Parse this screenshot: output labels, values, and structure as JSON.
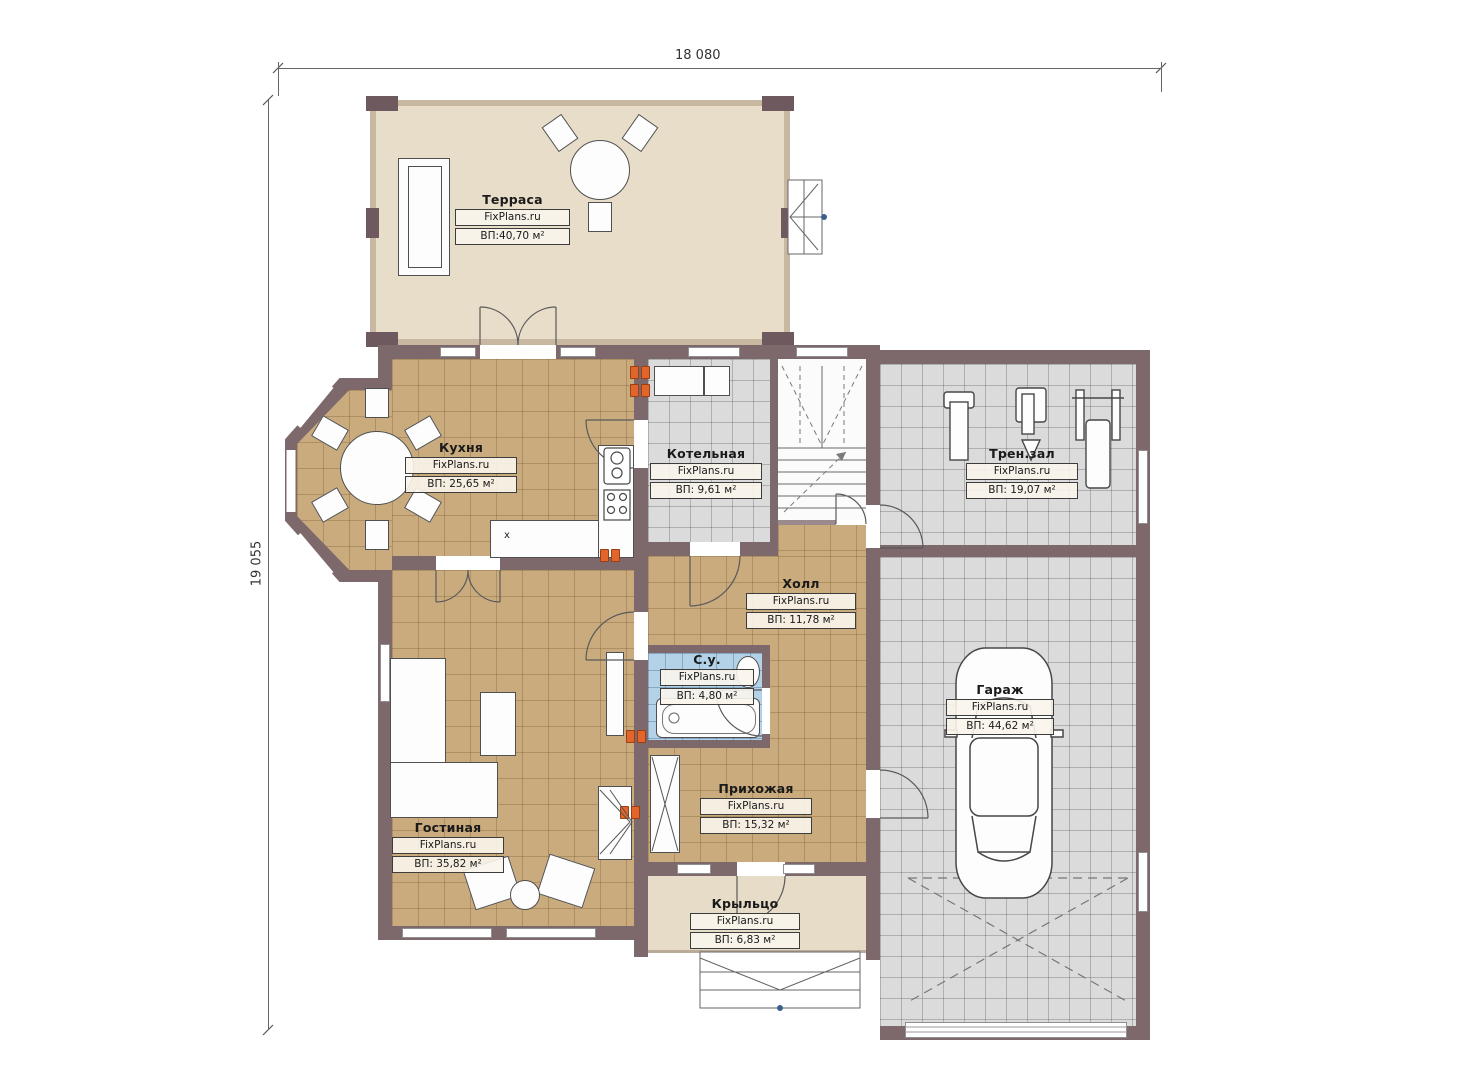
{
  "dimensions": {
    "top": "18 080",
    "left": "19 055"
  },
  "rooms": [
    {
      "name": "Терраса",
      "brand": "FixPlans.ru",
      "area": "ВП:40,70 м²"
    },
    {
      "name": "Кухня",
      "brand": "FixPlans.ru",
      "area": "ВП: 25,65 м²"
    },
    {
      "name": "Котельная",
      "brand": "FixPlans.ru",
      "area": "ВП: 9,61 м²"
    },
    {
      "name": "Трен.зал",
      "brand": "FixPlans.ru",
      "area": "ВП: 19,07 м²"
    },
    {
      "name": "Холл",
      "brand": "FixPlans.ru",
      "area": "ВП: 11,78 м²"
    },
    {
      "name": "С.у.",
      "brand": "FixPlans.ru",
      "area": "ВП: 4,80 м²"
    },
    {
      "name": "Гараж",
      "brand": "FixPlans.ru",
      "area": "ВП: 44,62 м²"
    },
    {
      "name": "Гостиная",
      "brand": "FixPlans.ru",
      "area": "ВП: 35,82 м²"
    },
    {
      "name": "Прихожая",
      "brand": "FixPlans.ru",
      "area": "ВП: 15,32 м²"
    },
    {
      "name": "Крыльцо",
      "brand": "FixPlans.ru",
      "area": "ВП: 6,83 м²"
    }
  ],
  "annotations": {
    "counter_mark": "x"
  },
  "colors": {
    "wall": "#7d686c",
    "tan_floor": "#c9ab7e",
    "gray_floor": "#dbdbdb",
    "blue_floor": "#b3d2e8",
    "beige_floor": "#e7dcc8",
    "radiator": "#e2662c"
  }
}
